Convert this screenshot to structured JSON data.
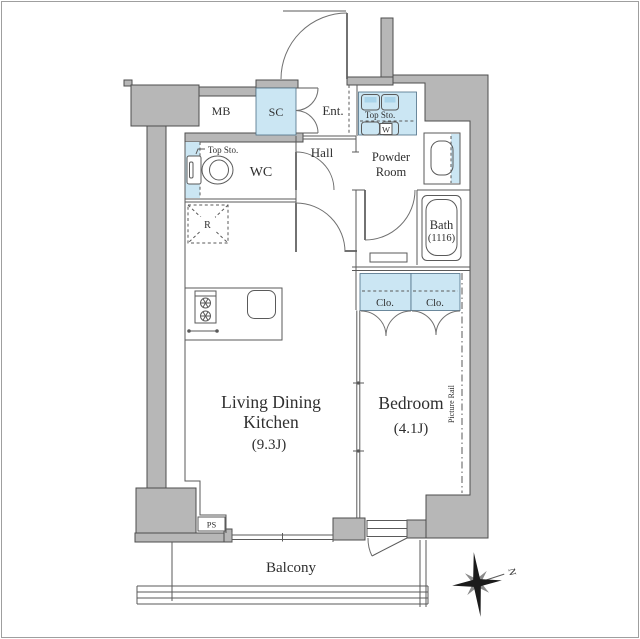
{
  "labels": {
    "mb": "MB",
    "sc": "SC",
    "ent": "Ent.",
    "hall": "Hall",
    "wc": "WC",
    "wc_top_storage": "Top Sto.",
    "powder_top_storage": "Top Sto.",
    "washer": "W",
    "powder_room_1": "Powder",
    "powder_room_2": "Room",
    "bath": "Bath",
    "bath_dim": "(1116)",
    "fridge": "R",
    "closet_1": "Clo.",
    "closet_2": "Clo.",
    "ldk_1": "Living Dining",
    "ldk_2": "Kitchen",
    "ldk_size": "(9.3J)",
    "bedroom": "Bedroom",
    "bedroom_size": "(4.1J)",
    "picture_rail": "Picture Rail",
    "ps": "PS",
    "balcony": "Balcony",
    "north": "N"
  },
  "colors": {
    "wall": "#b7b7b7",
    "wall_outline": "#4d4d4d",
    "highlight": "#cbe6f3",
    "highlight_dark": "#a9d4ea",
    "line": "#5a5a5a",
    "text": "#2f2f2f",
    "compass": "#1b1b1b",
    "compass_minor": "#8a8a8a"
  }
}
